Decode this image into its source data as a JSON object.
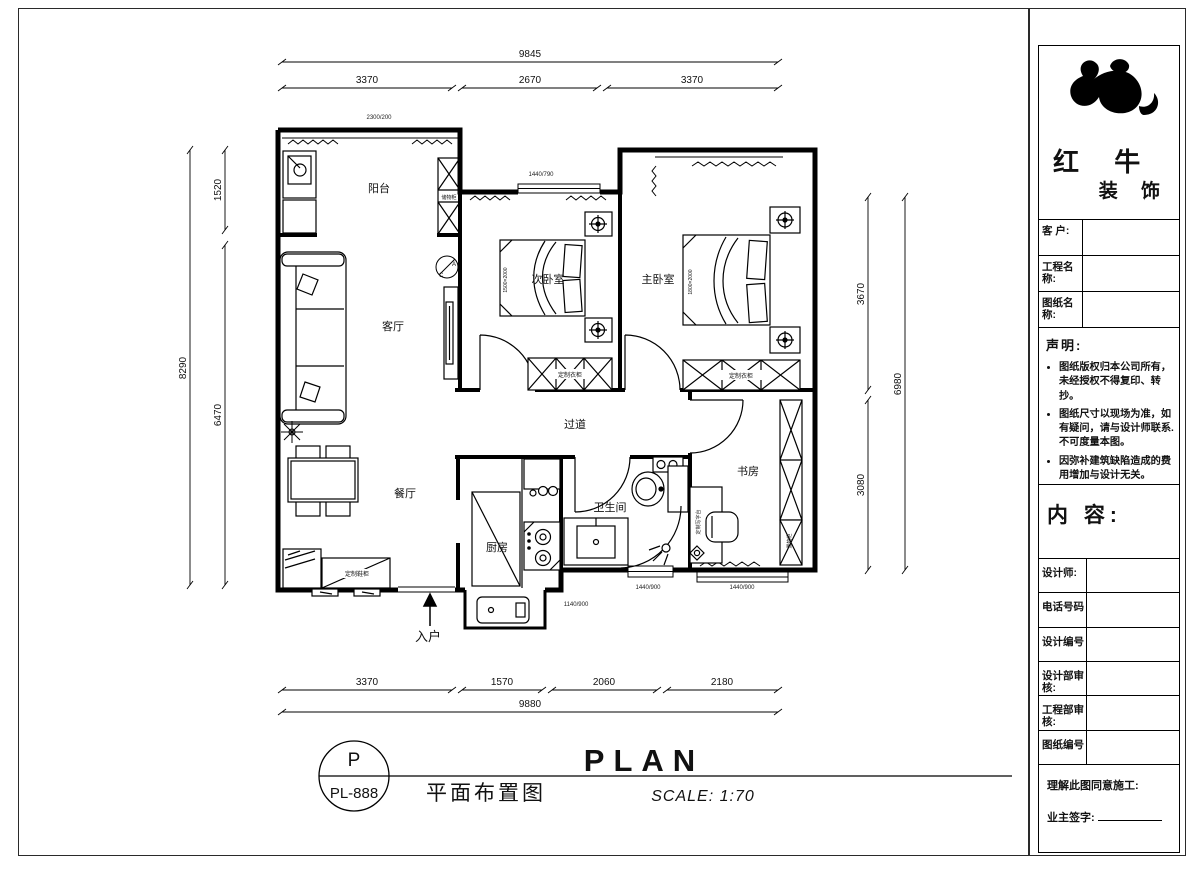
{
  "plan": {
    "rooms": {
      "balcony": "阳台",
      "living": "客厅",
      "dining": "餐厅",
      "bedroom2": "次卧室",
      "bedroom1": "主卧室",
      "corridor": "过道",
      "kitchen": "厨房",
      "bathroom": "卫生间",
      "study": "书房"
    },
    "labels": {
      "entrance": "入户",
      "wardrobe_secondary": "定制衣柜",
      "wardrobe_master": "定制衣柜",
      "shoe_cabinet": "定制鞋柜",
      "balcony_cabinet": "储物柜",
      "desk": "定制写字台",
      "bookcase": "置物柜",
      "bed_secondary_size": "1500×2000",
      "bed_master_size": "1800×2000",
      "ac_letter_a": "A",
      "ac_letter_c": "C"
    },
    "dims": {
      "top_total": "9845",
      "top_seg1": "3370",
      "top_seg2": "2670",
      "top_seg3": "3370",
      "left_total": "8290",
      "left_seg1": "1520",
      "left_seg2": "6470",
      "right_total": "6980",
      "right_seg1": "3670",
      "right_seg2": "3080",
      "bottom_seg1": "3370",
      "bottom_seg2": "1570",
      "bottom_seg3": "2060",
      "bottom_seg4": "2180",
      "bottom_total": "9880"
    },
    "fractions": {
      "f1": "2300/200",
      "f2": "1440/790",
      "f3": "1140/900",
      "f4": "1440/900",
      "f5": "1440/900"
    }
  },
  "footer": {
    "code_letter": "P",
    "code_number": "PL-888",
    "title_cn": "平面布置图",
    "title_en": "PLAN",
    "scale": "SCALE: 1:70"
  },
  "title_block": {
    "brand_line1": "红 牛",
    "brand_line2": "装 饰",
    "fields": [
      {
        "label": "客 户:"
      },
      {
        "label": "工程名称:"
      },
      {
        "label": "图纸名称:"
      }
    ],
    "statement": {
      "heading": "声明:",
      "items": [
        "图纸版权归本公司所有，未经授权不得复印、转抄。",
        "图纸尺寸以现场为准，如有疑问，请与设计师联系.不可度量本图。",
        "因弥补建筑缺陷造成的费用增加与设计无关。"
      ]
    },
    "content_heading": "内 容:",
    "info_rows": [
      {
        "label": "设计师:"
      },
      {
        "label": "电话号码"
      },
      {
        "label": "设计编号"
      },
      {
        "label": "设计部审核:"
      },
      {
        "label": "工程部审核:"
      },
      {
        "label": "图纸编号"
      }
    ],
    "approval": {
      "line1": "理解此图同意施工:",
      "line2": "业主签字:"
    }
  }
}
